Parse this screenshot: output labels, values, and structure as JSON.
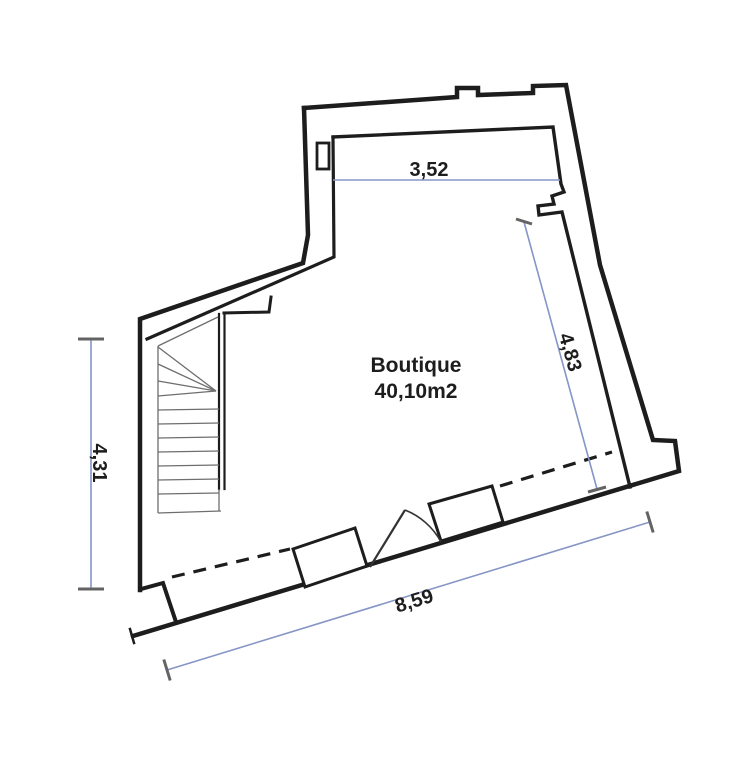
{
  "plan": {
    "room_label": {
      "line1": "Boutique",
      "line2": "40,10m2"
    },
    "dimensions": {
      "top_width": "3,52",
      "right_height": "4,83",
      "left_height": "4,31",
      "bottom_width": "8,59"
    },
    "colors": {
      "wall": "#1d1d1d",
      "stair_line": "#6e6e6e",
      "dimension_line": "#8595c5",
      "dimension_tick": "#636363",
      "door_line": "#333333",
      "text": "#1d1d1d",
      "background": "#ffffff"
    }
  }
}
